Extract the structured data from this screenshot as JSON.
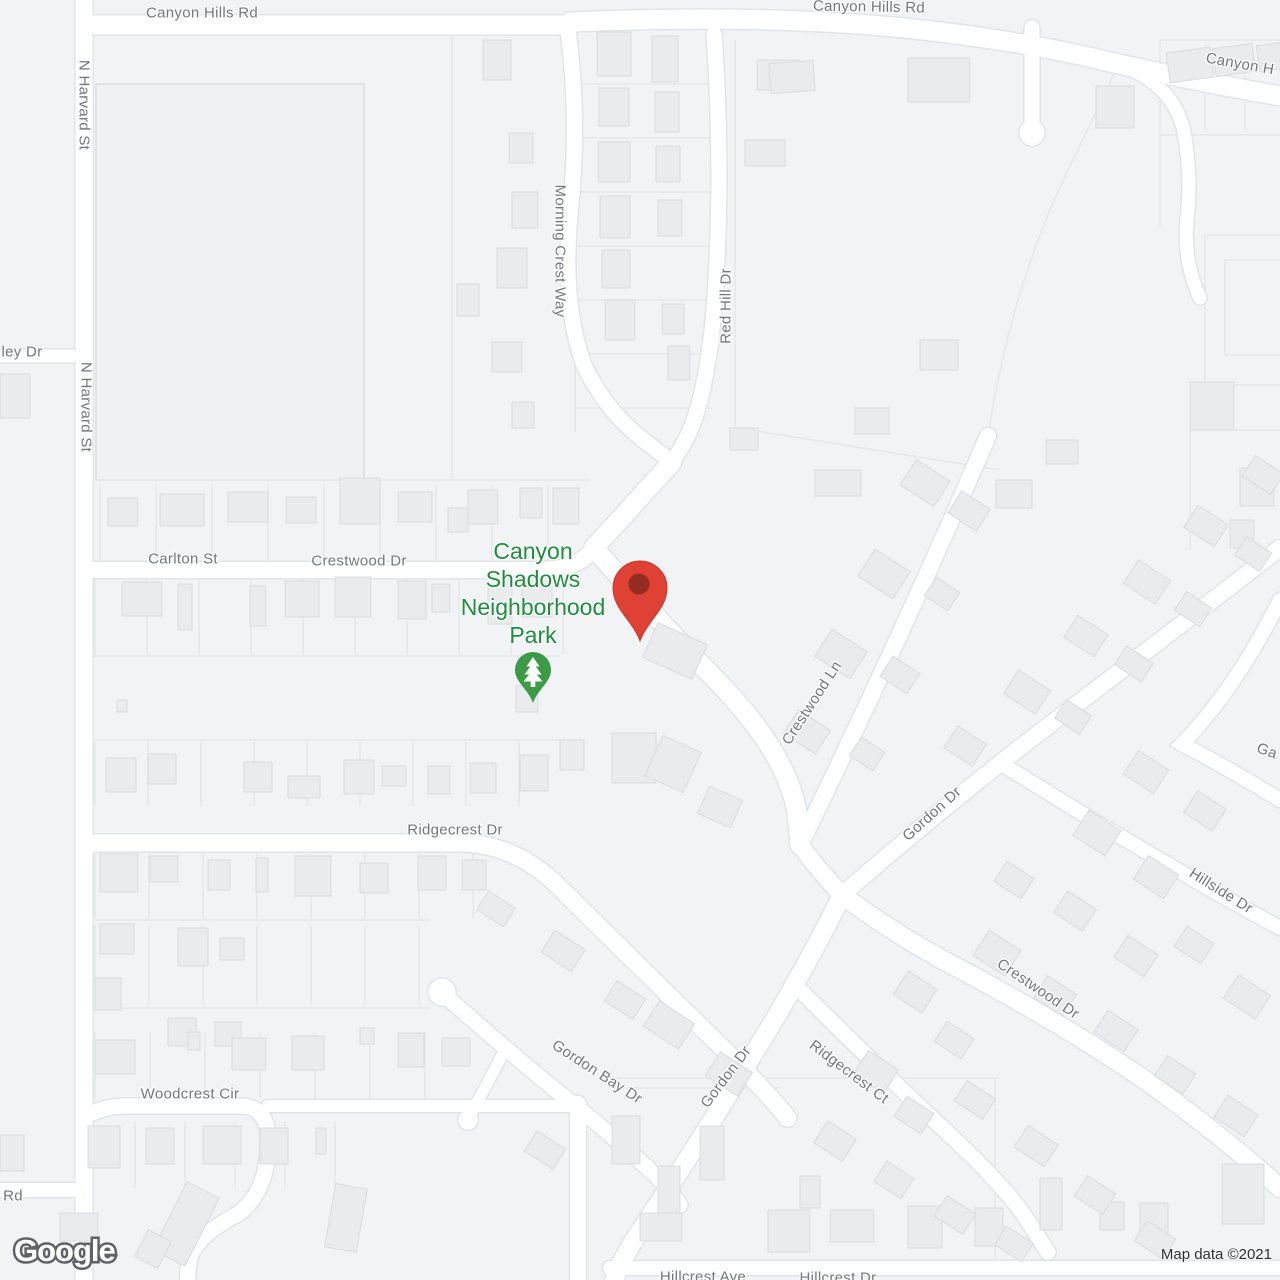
{
  "map": {
    "street_labels": [
      {
        "text": "Canyon Hills Rd",
        "x": 202,
        "y": 13,
        "rot": 0
      },
      {
        "text": "Canyon Hills Rd",
        "x": 869,
        "y": 7,
        "rot": 1
      },
      {
        "text": "Canyon H",
        "x": 1240,
        "y": 64,
        "rot": 10
      },
      {
        "text": "N Harvard St",
        "x": 84,
        "y": 105,
        "rot": 90
      },
      {
        "text": "N Harvard St",
        "x": 86,
        "y": 407,
        "rot": 90
      },
      {
        "text": "Morning Crest Way",
        "x": 560,
        "y": 251,
        "rot": 90
      },
      {
        "text": "Red Hill Dr",
        "x": 726,
        "y": 306,
        "rot": -90
      },
      {
        "text": "ley Dr",
        "x": 22,
        "y": 352,
        "rot": 0
      },
      {
        "text": "Carlton St",
        "x": 183,
        "y": 559,
        "rot": 0
      },
      {
        "text": "Crestwood Dr",
        "x": 359,
        "y": 561,
        "rot": 0
      },
      {
        "text": "Crestwood Ln",
        "x": 812,
        "y": 703,
        "rot": -57
      },
      {
        "text": "Gordon Dr",
        "x": 932,
        "y": 814,
        "rot": -42
      },
      {
        "text": "Ridgecrest Dr",
        "x": 455,
        "y": 830,
        "rot": 0
      },
      {
        "text": "Ga",
        "x": 1267,
        "y": 751,
        "rot": 20
      },
      {
        "text": "Hillside Dr",
        "x": 1221,
        "y": 891,
        "rot": 32
      },
      {
        "text": "Crestwood Dr",
        "x": 1038,
        "y": 989,
        "rot": 34
      },
      {
        "text": "Gordon Bay Dr",
        "x": 597,
        "y": 1072,
        "rot": 33
      },
      {
        "text": "Gordon Dr",
        "x": 726,
        "y": 1077,
        "rot": -53
      },
      {
        "text": "Ridgecrest Ct",
        "x": 849,
        "y": 1072,
        "rot": 37
      },
      {
        "text": "Woodcrest Cir",
        "x": 190,
        "y": 1094,
        "rot": 0
      },
      {
        "text": "Rd",
        "x": 13,
        "y": 1196,
        "rot": 0
      },
      {
        "text": "Hillcrest Ave",
        "x": 703,
        "y": 1277,
        "rot": 0
      },
      {
        "text": "Hillcrest Dr",
        "x": 838,
        "y": 1278,
        "rot": 0
      }
    ],
    "poi": {
      "name": "Canyon Shadows Neighborhood Park",
      "label_multiline": "Canyon\nShadows\nNeighborhood\nPark"
    },
    "colors": {
      "poi_green": "#1E8E3E",
      "park_pin_green": "#3C9B47",
      "pin_red": "#DF4234",
      "pin_red_dark": "#962D22",
      "label_gray": "#72777C",
      "road_fill": "#FFFFFF",
      "background": "#F1F3F4",
      "building_fill": "#E9EBED"
    }
  },
  "watermark": {
    "logo": "Google"
  },
  "attribution": {
    "text": "Map data ©2021"
  }
}
